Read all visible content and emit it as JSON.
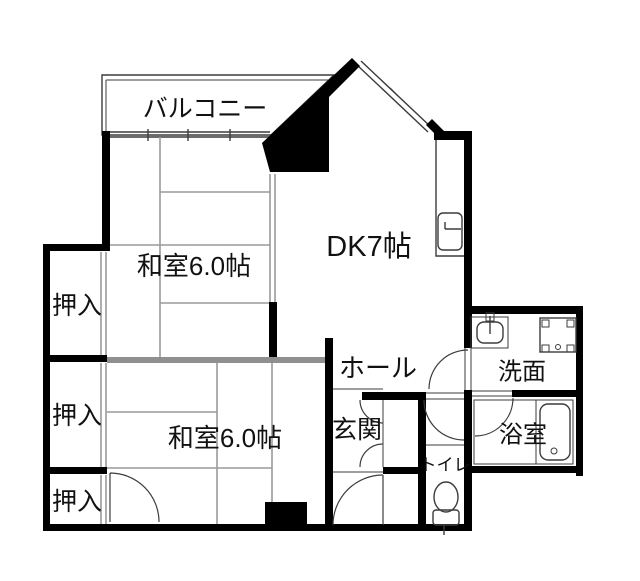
{
  "canvas": {
    "width": 640,
    "height": 581
  },
  "colors": {
    "wall": "#000000",
    "line": "#3c3c3c",
    "grid": "#9a9a9a",
    "graywall": "#8f8f8f",
    "text": "#111111",
    "bg": "#ffffff"
  },
  "rooms": {
    "balcony": {
      "label": "バルコニー"
    },
    "washitsu_upper": {
      "label": "和室6.0帖"
    },
    "dk": {
      "label": "DK7帖"
    },
    "oshiire_1": {
      "label": "押入"
    },
    "oshiire_2": {
      "label": "押入"
    },
    "oshiire_3": {
      "label": "押入"
    },
    "washitsu_lower": {
      "label": "和室6.0帖"
    },
    "hall": {
      "label": "ホール"
    },
    "genkan": {
      "label": "玄関"
    },
    "toilet": {
      "label": "トイレ"
    },
    "senmen": {
      "label": "洗面"
    },
    "bath": {
      "label": "浴室"
    }
  },
  "fixtures": {
    "kitchen_sink": "kitchen-sink",
    "wash_basin": "wash-basin",
    "washing_machine_pan": "washing-machine-pan",
    "bathtub": "bathtub",
    "toilet_bowl": "toilet-bowl"
  }
}
